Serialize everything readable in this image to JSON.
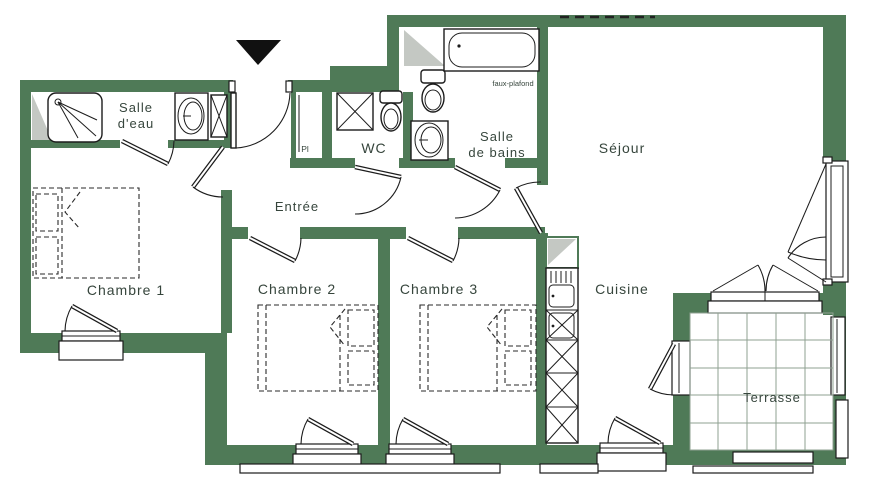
{
  "plan": {
    "type": "apartment-floor-plan",
    "wall_color": "#4f7a57",
    "shade_color": "#c4c8c3",
    "line_color": "#1c1c1c",
    "text_color": "#36453c",
    "entrance_marker": "black triangle pointing down at front door"
  },
  "rooms": {
    "salle_deau": {
      "line1": "Salle",
      "line2": "d'eau"
    },
    "chambre1": {
      "label": "Chambre 1"
    },
    "entree": {
      "label": "Entrée"
    },
    "wc": {
      "label": "WC"
    },
    "salle_de_bains": {
      "line1": "Salle",
      "line2": "de bains"
    },
    "sejour": {
      "label": "Séjour"
    },
    "chambre2": {
      "label": "Chambre 2"
    },
    "chambre3": {
      "label": "Chambre 3"
    },
    "cuisine": {
      "label": "Cuisine"
    },
    "terrasse": {
      "label": "Terrasse"
    },
    "placard": {
      "label": "Pl"
    }
  },
  "annotations": {
    "faux_plafond": "faux-plafond"
  }
}
